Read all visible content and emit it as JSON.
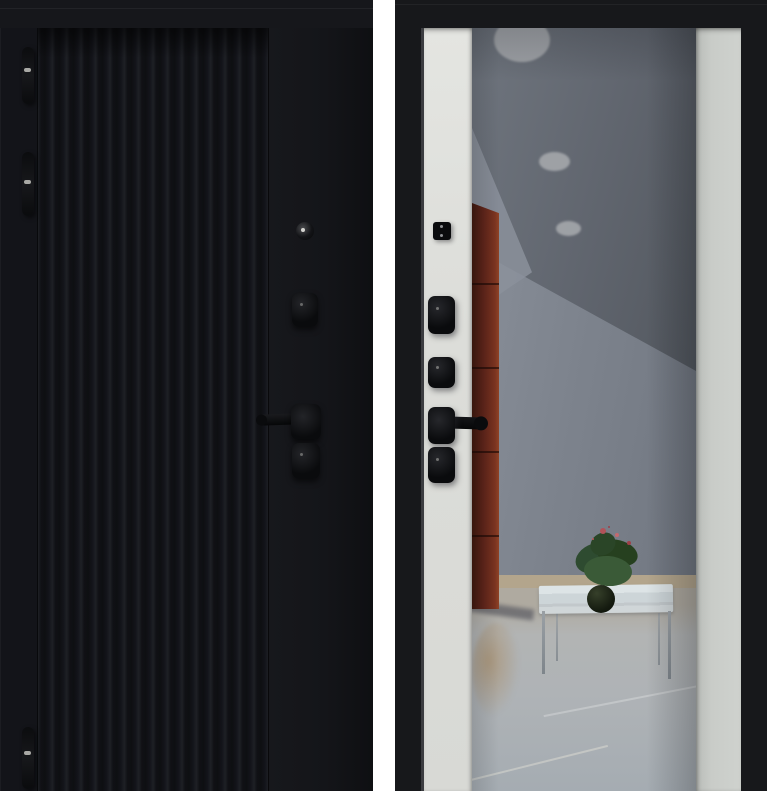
{
  "image": {
    "kind": "product-photo",
    "subject": "steel entry door shown twice: exterior side (left) and interior side (right)",
    "visible_text": ""
  },
  "views": {
    "exterior": {
      "name": "exterior-side",
      "finish": "matte black with vertical slat milling on left two-thirds, flat stile on right",
      "hardware": [
        "top hinge",
        "middle hinge",
        "bottom hinge",
        "lock cylinder",
        "upper escutcheon",
        "lever handle pointing left",
        "lower escutcheon"
      ]
    },
    "interior": {
      "name": "interior-side",
      "finish": "black frame, light panels flanking a full-height mirror insert",
      "hardware": [
        "night latch plate",
        "upper deadbolt escutcheon",
        "middle deadbolt escutcheon",
        "lever handle pointing right",
        "lower deadbolt escutcheon"
      ],
      "mirror_reflection": [
        "gray ceiling with three recessed round lights",
        "red-brown tall cabinet on left",
        "light coffee table with thin metal legs",
        "potted plant with red flowers",
        "light tiled floor with diagonal seams"
      ]
    }
  },
  "colors": {
    "gap-white": "#ffffff",
    "door-black": "#131419",
    "slat-dark": "#101115",
    "slat-light": "#1e2025",
    "hardware-black": "#0a0b0d",
    "frame-black": "#17181b",
    "panel-left": "#e4e5e1",
    "panel-right": "#c9ccc8",
    "ceiling-gray": "#60656e",
    "wall-gray": "#7d838d",
    "wall-light": "#8b919b",
    "light-spot": "#a3a6aa",
    "cabinet-red": "#61251a",
    "cabinet-dark": "#3f180d",
    "floor-gray": "#b2b4b4",
    "floor-tan": "#b3a58c",
    "table-top": "#cdd5d8",
    "table-leg": "#7e858b",
    "plant-green": "#2e4b30",
    "plant-flower": "#b25258",
    "pot-dark": "#151b10"
  }
}
